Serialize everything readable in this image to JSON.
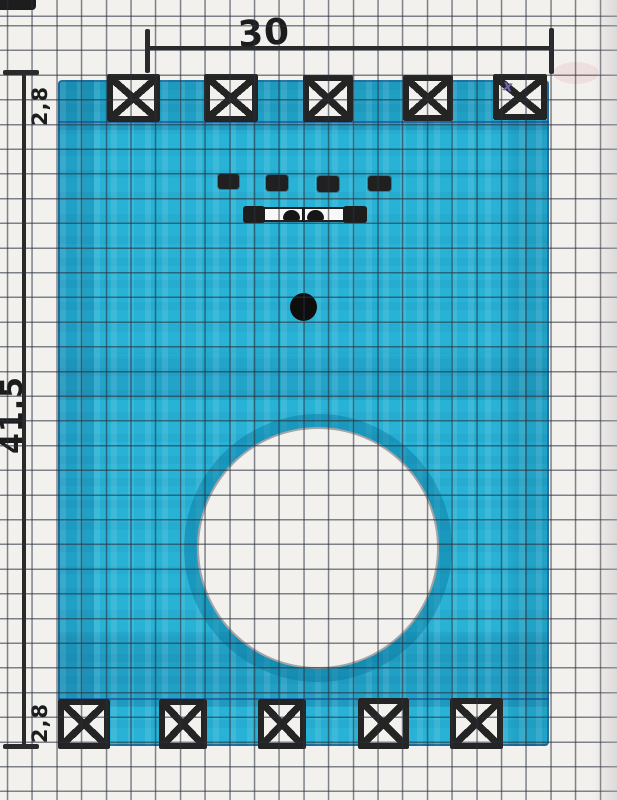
{
  "title": "Hand-drawn part sketch on graph paper",
  "colors": {
    "marker_fill": "#27b2d6",
    "marker_edge": "#1d4f8a",
    "ink": "#242424",
    "paper": "#f3f1ee",
    "grid_line": "#74787e",
    "pencil_mark": "#6f63ab"
  },
  "dimensions": {
    "width_label": "30",
    "height_label": "41.5",
    "top_band_label": "2,8",
    "bottom_band_label": "2,8"
  },
  "annotations": {
    "pencil_check": "x"
  },
  "fasteners": {
    "top_count": 5,
    "bottom_count": 5
  },
  "components": {
    "button_count": 4,
    "large_cutout": "circle",
    "small_hole": "dot",
    "connector": "terminal-strip"
  }
}
